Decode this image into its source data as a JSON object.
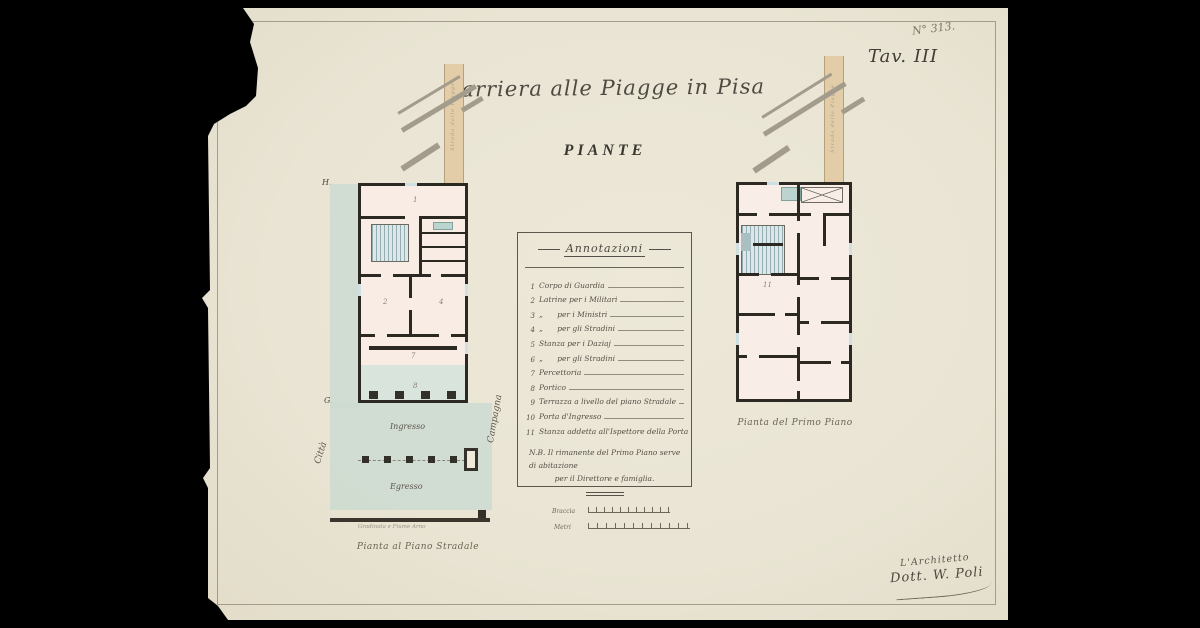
{
  "document": {
    "archive_number": "N° 313.",
    "plate": "Tav. III",
    "title": "Barriera alle Piagge in Pisa",
    "subtitle": "PIANTE"
  },
  "plan_ground": {
    "caption": "Pianta al Piano Stradale",
    "marker_top": "H.",
    "marker_bottom": "G.",
    "label_citta": "Città",
    "label_campagna": "Campagna",
    "label_ingresso": "Ingresso",
    "label_egresso": "Egresso",
    "road_label": "Strada delle Piagge",
    "embankment_note": "Gradinata e Fiume Arno",
    "room_numbers": {
      "r1": "1",
      "r2": "2",
      "r4": "4",
      "r7": "7",
      "r8": "8"
    }
  },
  "plan_first": {
    "caption": "Pianta del Primo Piano",
    "road_label": "Strada delle Piagge",
    "room_number": "11"
  },
  "annotations": {
    "title": "Annotazioni",
    "items": [
      {
        "num": "1",
        "text": "Corpo di Guardia"
      },
      {
        "num": "2",
        "text": "Latrine per i Militari"
      },
      {
        "num": "3",
        "text": "„      per i Ministri"
      },
      {
        "num": "4",
        "text": "„      per gli Stradini"
      },
      {
        "num": "5",
        "text": "Stanza per i Daziaj"
      },
      {
        "num": "6",
        "text": "„      per gli Stradini"
      },
      {
        "num": "7",
        "text": "Percettoria"
      },
      {
        "num": "8",
        "text": "Portico"
      },
      {
        "num": "9",
        "text": "Terrazza a livello del piano Stradale"
      },
      {
        "num": "10",
        "text": "Porta d'Ingresso"
      },
      {
        "num": "11",
        "text": "Stanza addetta all'Ispettore della Porta"
      }
    ],
    "nb_line1": "N.B.   Il rimanente del Primo Piano serve di abitazione",
    "nb_line2": "per il Direttore e famiglia."
  },
  "scale": {
    "braccia": "Braccia",
    "metri": "Metri"
  },
  "signature": {
    "role": "L'Architetto",
    "name": "Dott. W. Poli"
  },
  "colors": {
    "paper": "#e9e4d3",
    "wall_ink": "#2c2923",
    "room_fill": "#f8ece4",
    "green_wash": "#ccdad1",
    "road_tan": "#e2cda8",
    "stair_teal": "#93adb3"
  }
}
